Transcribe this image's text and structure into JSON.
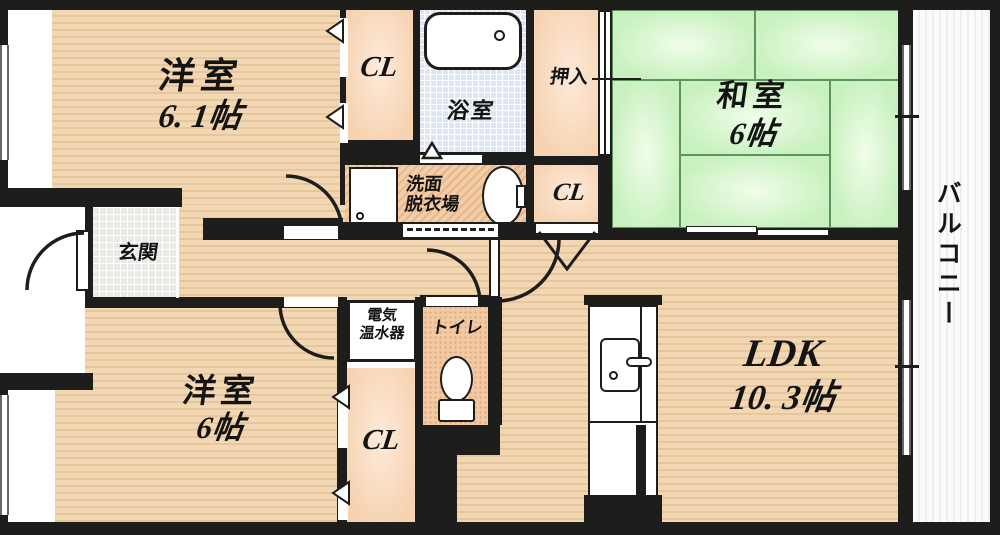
{
  "plan_type": "apartment-floorplan",
  "rooms": {
    "western1": {
      "label": "洋室",
      "size": "6. 1帖"
    },
    "western2": {
      "label": "洋室",
      "size": "6帖"
    },
    "japanese": {
      "label": "和室",
      "size": "6帖"
    },
    "ldk": {
      "label": "LDK",
      "size": "10. 3帖"
    },
    "bath": {
      "label": "浴室"
    },
    "washroom": {
      "line1": "洗面",
      "line2": "脱衣場"
    },
    "toilet": {
      "label": "トイレ"
    },
    "entrance": {
      "label": "玄関"
    },
    "oshiire": {
      "label": "押入"
    },
    "balcony": {
      "label": "バルコニー"
    },
    "cl_top": {
      "label": "CL"
    },
    "cl_mid": {
      "label": "CL"
    },
    "cl_bottom": {
      "label": "CL"
    },
    "water_heater": {
      "line1": "電気",
      "line2": "温水器"
    }
  },
  "colors": {
    "wall": "#1d1d1b",
    "wood_floor": "#f3d7b4",
    "wood_stripe": "#e6c69b",
    "closet_fill": "#f6d2b0",
    "washroom_fill": "#eec09c",
    "tatami_green": "#c9f1c0",
    "tatami_line": "#5d935c",
    "bath_blue": "#dde6f4",
    "entrance_tile": "#e9e9e6",
    "balcony_white": "#fbfbfa"
  }
}
